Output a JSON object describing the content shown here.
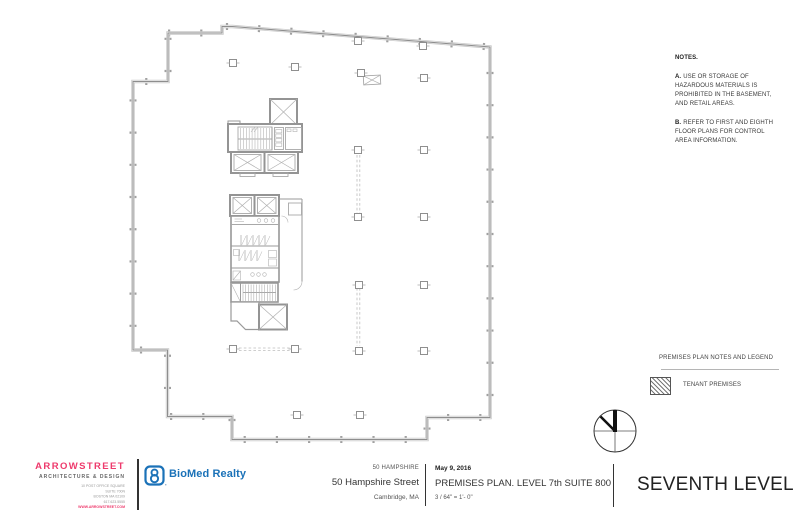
{
  "notes": {
    "title": "NOTES.",
    "item_a": {
      "label": "A.",
      "lines": [
        "USE OR STORAGE OF",
        "HAZARDOUS MATERIALS IS",
        "PROHIBITED IN THE BASEMENT,",
        "AND RETAIL AREAS."
      ]
    },
    "item_b": {
      "label": "B.",
      "lines": [
        "REFER TO FIRST AND EIGHTH",
        "FLOOR PLANS FOR CONTROL",
        "AREA INFORMATION."
      ]
    }
  },
  "legend": {
    "title": "PREMISES PLAN NOTES AND LEGEND",
    "tenant_premises_label": "TENANT PREMISES",
    "swatch_style": "diagonal-hatch"
  },
  "title_block": {
    "architect": {
      "name": "ARROWSTREET",
      "tagline": "ARCHITECTURE & DESIGN",
      "address_lines": [
        "10 POST OFFICE SQUARE",
        "SUITE 700N",
        "BOSTON MA 02109",
        "617.623.5555"
      ],
      "website": "WWW.ARROWSTREET.COM"
    },
    "client": {
      "name": "BioMed Realty"
    },
    "project": {
      "label": "50 HAMPSHIRE",
      "street": "50 Hampshire Street",
      "city": "Cambridge, MA"
    },
    "sheet_info": {
      "date": "May 9, 2016",
      "title": "PREMISES PLAN. LEVEL 7th SUITE 800",
      "scale": "3 / 64\" = 1'- 0\""
    },
    "level_name": "SEVENTH LEVEL"
  },
  "colors": {
    "accent_pink": "#ee3a6c",
    "brand_blue": "#1b72b8",
    "plan_line_gray": "#9a9a9a",
    "text_dark": "#222222"
  }
}
